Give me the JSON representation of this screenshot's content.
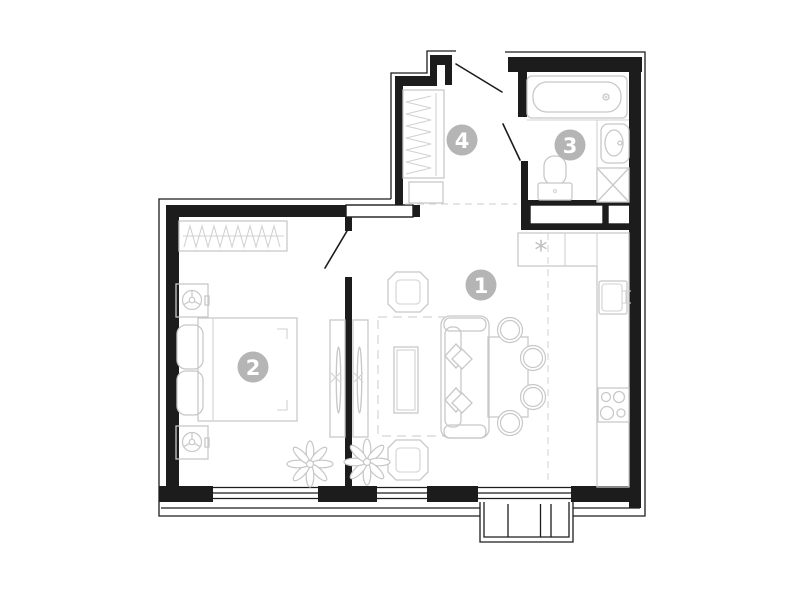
{
  "plan": {
    "type": "apartment-floor-plan",
    "rooms": [
      {
        "number": "1",
        "name": "living-room-kitchen"
      },
      {
        "number": "2",
        "name": "bedroom"
      },
      {
        "number": "3",
        "name": "bathroom"
      },
      {
        "number": "4",
        "name": "entry-hall-wardrobe"
      }
    ],
    "symbols": {
      "fridge": "*"
    },
    "colors": {
      "walls": "#1c1c1c",
      "furniture_outline": "#c8c8c8",
      "room_label_circle": "#b5b5b5",
      "room_label_text": "#ffffff",
      "zone_dash": "#d8d8d8",
      "background": "#ffffff"
    }
  }
}
